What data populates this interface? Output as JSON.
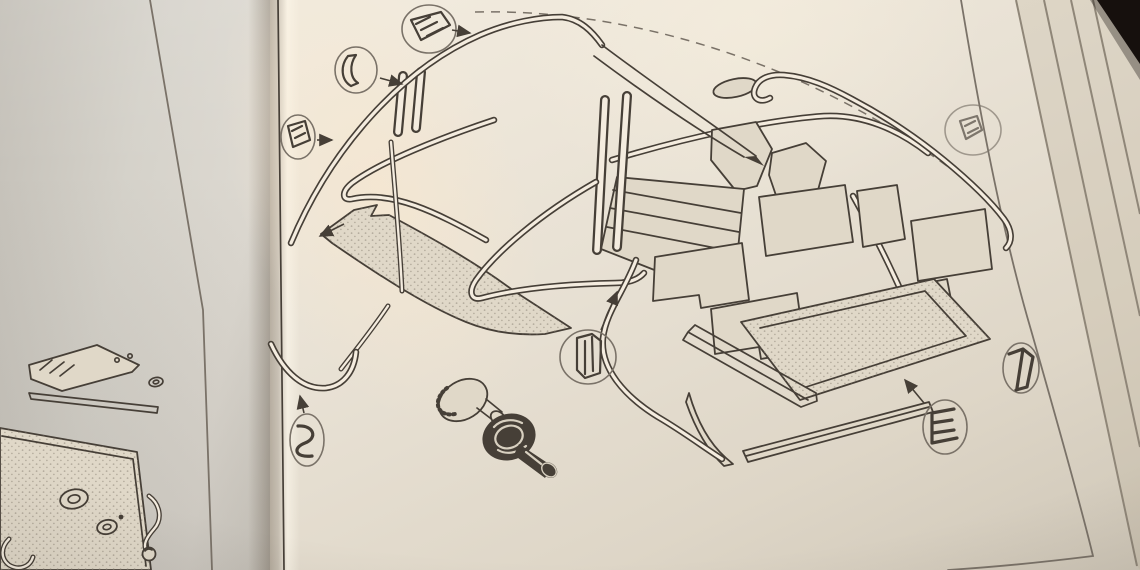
{
  "scene": {
    "kind": "photograph-of-open-book",
    "visible_text": "none",
    "right_page_subject": "exploded-diagram-of-weatherseals-carpet-set-and-fasteners",
    "left_page_subject": "partial-diagram-of-trim-panel-bracket-and-window-crank"
  },
  "colors": {
    "bg_dark": "#16100d",
    "paper_right": "#e8e1d4",
    "paper_right_bright": "#f4ecdf",
    "paper_right_dim": "#cfc7b8",
    "paper_left": "#d5d2ca",
    "paper_left_dim": "#c3bfb7",
    "gutter": "#a3968a",
    "ink": "#463f37",
    "ink_soft": "#7a7268",
    "panel_fill": "#e0d8c8",
    "stipple": "#8d8477",
    "page_edge_line": "#8f8678",
    "glare": "#f6e9d2"
  },
  "left_page": {
    "illustration": {
      "parts": [
        "mounting-bracket",
        "finisher-strip",
        "small-grommet",
        "trim-panel",
        "panel-grommet-large",
        "panel-grommet-small",
        "window-winder-crank",
        "pull-loop"
      ]
    }
  },
  "right_page": {
    "illustration": {
      "body_outline": "dashed-phantom-arc",
      "seal_rails": [
        "windscreen-header-seal",
        "a-pillar-taper-rail",
        "door-aperture-loop-left",
        "door-aperture-loop-right",
        "b-post-channel-pair-left",
        "b-post-channel-pair-center",
        "cockpit-s-channel",
        "rear-deck-hook-seal",
        "rear-horizontal-rail",
        "quarter-rail",
        "front-corner-dip-seal",
        "thin-rod-seal",
        "stub-seal"
      ],
      "carpet_panels": [
        "scuttle-blade-panel",
        "bulkhead-pad-left",
        "bulkhead-pad-right",
        "ribbed-floor-carpet",
        "mid-carpet-1",
        "mid-carpet-2",
        "mid-carpet-3",
        "mid-carpet-4",
        "mid-carpet-5",
        "mid-carpet-6",
        "boot-floor-carpet",
        "sill-channel",
        "sill-strip",
        "curved-sill-blade"
      ],
      "fasteners": [
        "snap-button-plain",
        "snap-button-rosette"
      ],
      "callouts": [
        {
          "id": "top",
          "glyph": "hatched-corner-section"
        },
        {
          "id": "upper-left",
          "glyph": "curved-channel-section"
        },
        {
          "id": "left",
          "glyph": "hatched-block-section"
        },
        {
          "id": "center",
          "glyph": "channel-block-section"
        },
        {
          "id": "lower-left",
          "glyph": "s-profile-section"
        },
        {
          "id": "right-upper",
          "glyph": "hatched-block-section-faint"
        },
        {
          "id": "right-mid",
          "glyph": "folded-v-section"
        },
        {
          "id": "right-lower",
          "glyph": "e-channel-section"
        }
      ]
    }
  },
  "book": {
    "page_stack_lines": 4,
    "dark_corner": "top-right"
  }
}
